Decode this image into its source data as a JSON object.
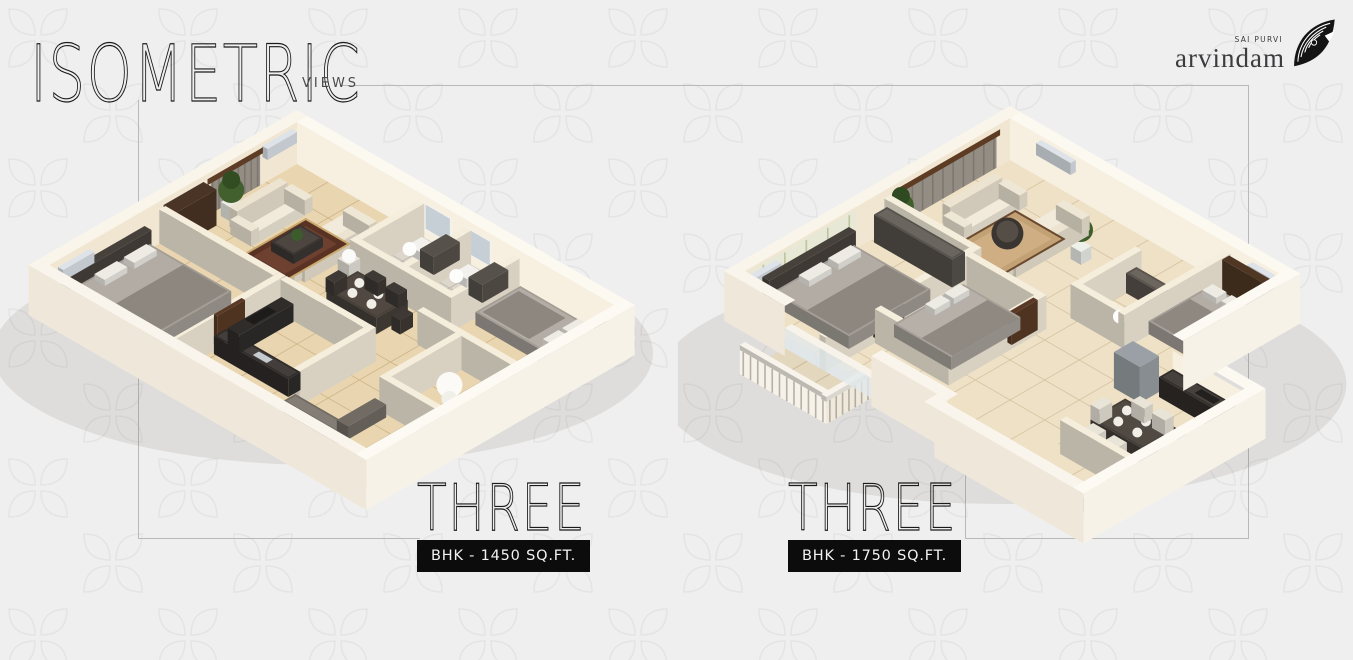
{
  "header": {
    "title": "ISOMETRIC",
    "subtitle": "VIEWS"
  },
  "brand": {
    "name": "arvindam",
    "tagline": "SAI PURVI"
  },
  "plans": [
    {
      "title": "THREE",
      "spec": "BHK - 1450 SQ.FT."
    },
    {
      "title": "THREE",
      "spec": "BHK - 1750 SQ.FT."
    }
  ],
  "colors": {
    "background": "#efefef",
    "pattern_outline": "#e4e4e4",
    "badge_black": "#0c0c0c",
    "frame_line": "#b9b9b9",
    "wall_cream": "#f6eedd",
    "floor_beige": "#e9d6b0",
    "floor_beige_light": "#eee1c6"
  }
}
